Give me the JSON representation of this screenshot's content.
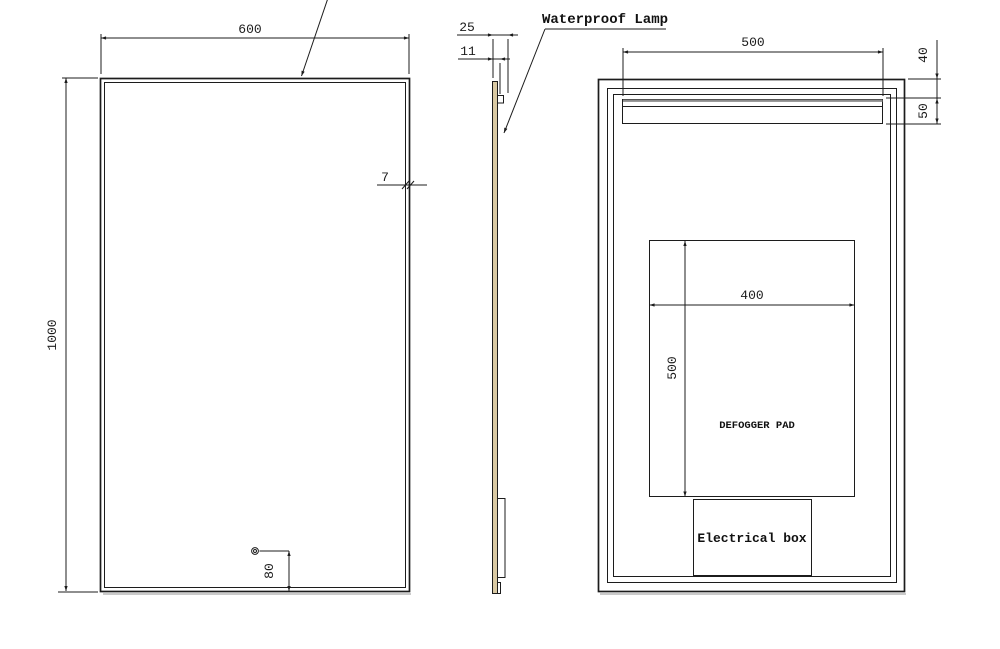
{
  "drawing": {
    "labels": {
      "waterproof_lamp": "Waterproof Lamp",
      "defogger_pad": "DEFOGGER PAD",
      "electrical_box": "Electrical box"
    },
    "front_view": {
      "width": "600",
      "height": "1000",
      "frame_edge": "7",
      "sensor_offset": "80"
    },
    "side_view": {
      "total_depth": "25",
      "glass_thickness": "11"
    },
    "back_view": {
      "lamp_width": "500",
      "lamp_top_offset": "40",
      "lamp_height": "50",
      "pad_width": "400",
      "pad_height": "500"
    },
    "colors": {
      "line": "#1c1c1c",
      "background": "#ffffff",
      "glass_edge_fill": "#d9c9a3",
      "lamp_gray": "#8c8c8c"
    }
  }
}
